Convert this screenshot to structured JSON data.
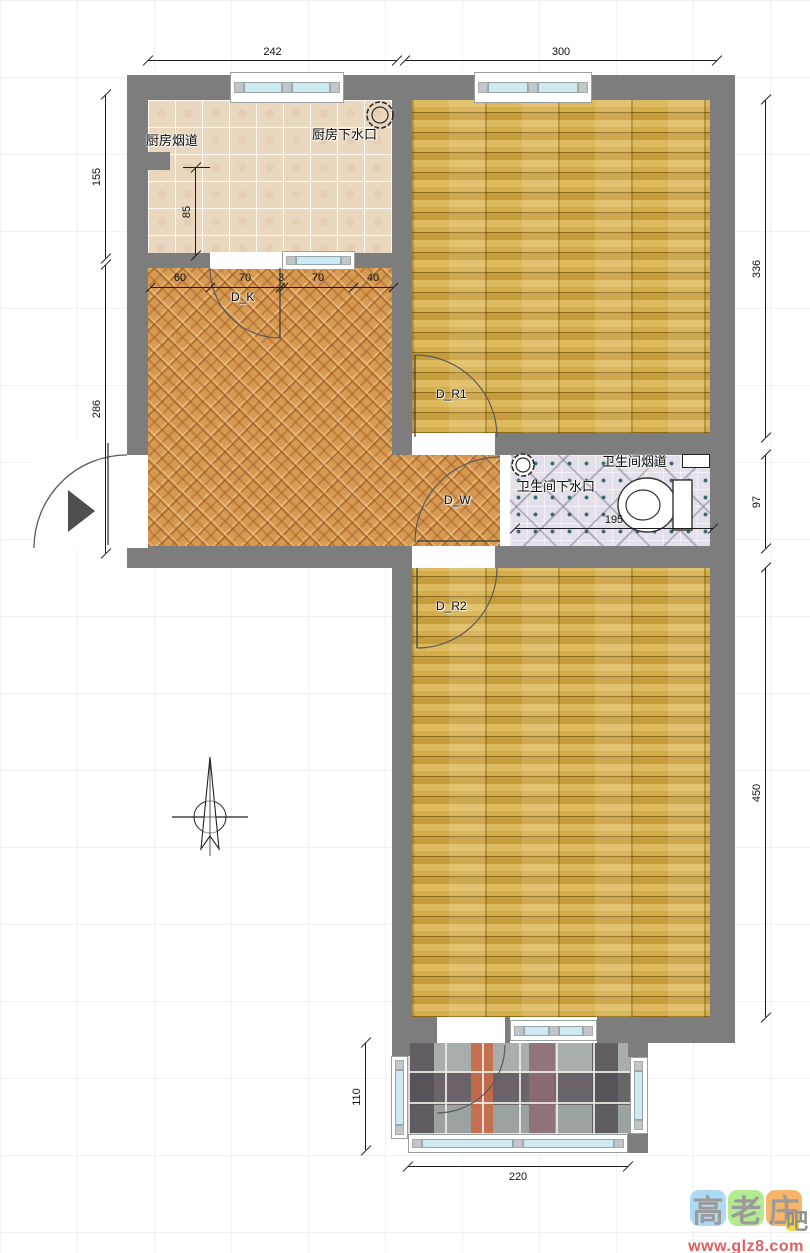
{
  "plan": {
    "annotations": {
      "kitchen_flue": "厨房烟道",
      "kitchen_drain": "厨房下水口",
      "bath_flue": "卫生间烟道",
      "bath_drain": "卫生间下水口"
    },
    "doors": {
      "kitchen": "D_K",
      "room1": "D_R1",
      "wc": "D_W",
      "room2": "D_R2"
    },
    "dims": {
      "top_kitchen": "242",
      "top_room1": "300",
      "left_kitchen": "155",
      "left_living": "286",
      "right_room1": "336",
      "right_bath": "97",
      "right_room2": "450",
      "kitchen_inner": "85",
      "bath_width": "195",
      "balcony_height": "110",
      "balcony_width": "220",
      "segments": [
        "60",
        "70",
        "3",
        "70",
        "40"
      ]
    },
    "colors": {
      "wall": "#7d7d7d",
      "wood_floor": "#c9a143",
      "carpet": "#d69a52",
      "kitchen_tile": "#ead7bf",
      "bath_tile": "#e5dfe9",
      "balcony_stone": "#98a09e",
      "window_glass": "#cfe9f2"
    }
  },
  "watermark": {
    "char1": "高",
    "char2": "老",
    "char3": "庄",
    "suffix": "吧",
    "url": "www.glz8.com",
    "tile_colors": [
      "#9fd4f2",
      "#a8e87e",
      "#f5a94f"
    ]
  }
}
